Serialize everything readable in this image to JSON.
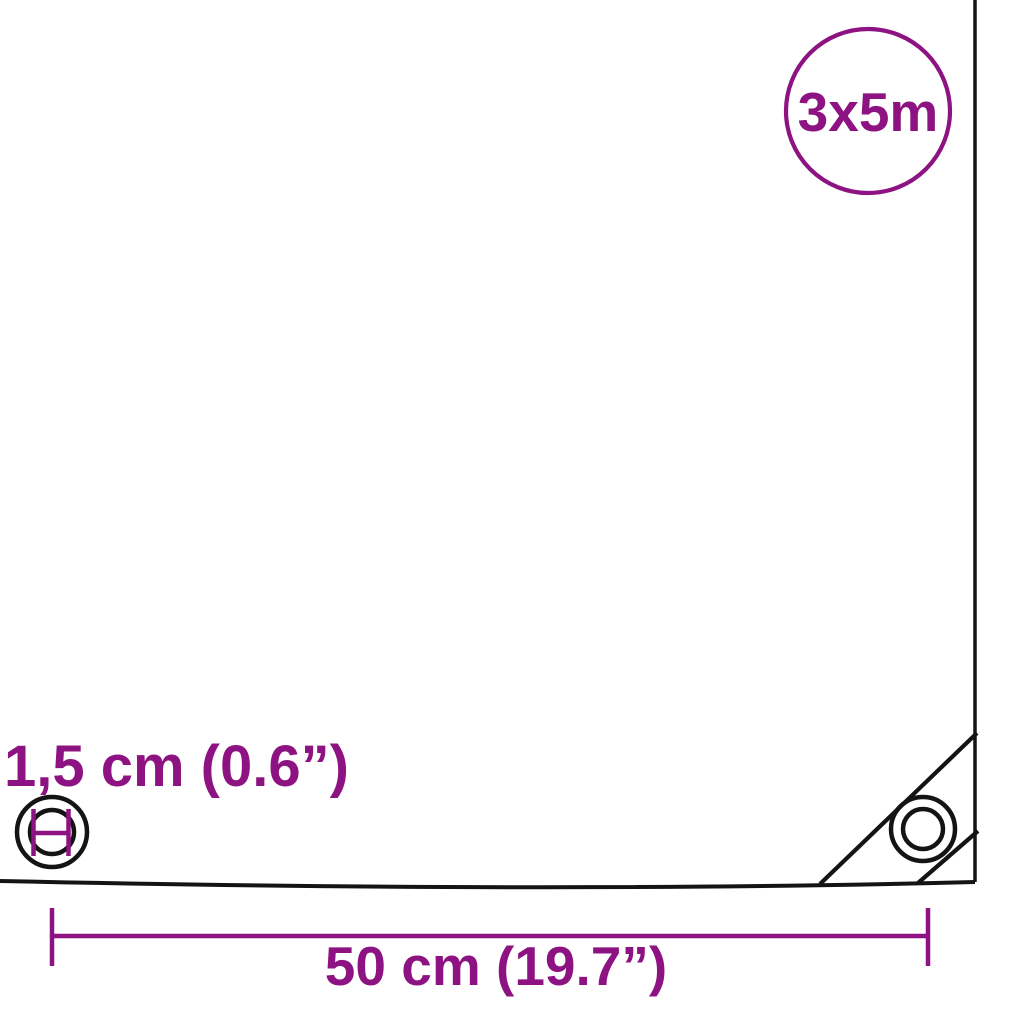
{
  "diagram": {
    "type": "product-dimension-diagram",
    "product": "tarpaulin",
    "badge": {
      "label": "3x5m"
    },
    "labels": {
      "eyelet_diameter": "1,5 cm (0.6”)",
      "eyelet_spacing": "50 cm (19.7”)"
    },
    "colors": {
      "accent": "#8e1382",
      "line": "#141414",
      "background": "#ffffff"
    },
    "icons": [
      {
        "name": "size-badge-circle",
        "meaning": "overall tarp size 3x5 m"
      },
      {
        "name": "left-eyelet-icon",
        "meaning": "eyelet with diameter marker"
      },
      {
        "name": "corner-eyelet-icon",
        "meaning": "reinforced corner eyelet"
      },
      {
        "name": "dimension-line",
        "meaning": "eyelet spacing 50 cm"
      }
    ]
  }
}
